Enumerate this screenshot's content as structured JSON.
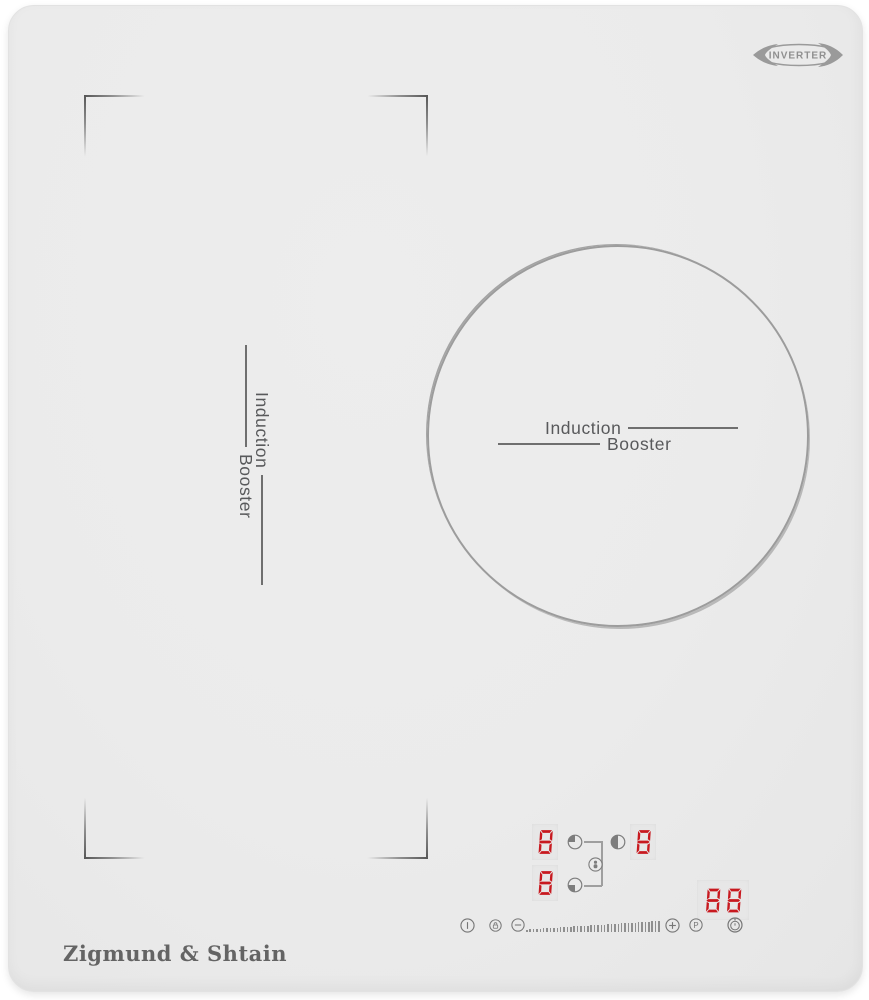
{
  "brand": {
    "logo": "Zigmund & Shtain",
    "badge": "INVERTER",
    "badge_icon": "inverter-swoosh-ellipse"
  },
  "zones": {
    "left_flex": {
      "label_line1": "Induction",
      "label_line2": "Booster"
    },
    "right_round": {
      "label_line1": "Induction",
      "label_line2": "Booster"
    }
  },
  "displays": {
    "left_rear_level": "8",
    "left_front_level": "8",
    "right_level": "8",
    "timer_value": "88",
    "child_lock_icon": "child-lock-person-in-circle-icon",
    "zone_icons": {
      "left_rear": "circle-quarter-top-left-filled-icon",
      "left_front": "circle-quarter-bottom-left-filled-icon",
      "right": "circle-half-left-filled-icon"
    }
  },
  "controls": {
    "power": {
      "icon": "power-icon"
    },
    "child_lock": {
      "icon": "padlock-icon"
    },
    "decrease": {
      "icon": "minus-icon"
    },
    "power_slider": {
      "icon": "tick-ramp-slider"
    },
    "increase": {
      "icon": "plus-icon"
    },
    "booster": {
      "label": "P"
    },
    "timer": {
      "icon": "alarm-clock-icon"
    }
  },
  "colors": {
    "surface": "#ebebeb",
    "card": "#e7e7e7",
    "digit_red": "#c8191f",
    "stroke_gray": "#9a9a9a",
    "icon_gray": "#767676",
    "label_gray": "#58595b",
    "logo_gray": "#646464"
  },
  "slider": {
    "tick_count": 40,
    "min_tick_height": 2.5,
    "max_tick_height": 11
  }
}
